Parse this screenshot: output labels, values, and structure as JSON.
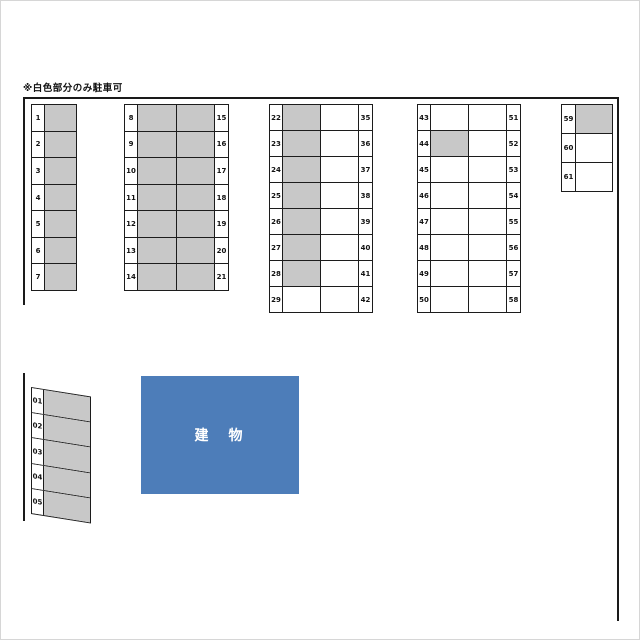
{
  "note": "※白色部分のみ駐車可",
  "building": {
    "label": "建　物"
  },
  "colors": {
    "occupied": "#c8c8c8",
    "available": "#ffffff",
    "building": "#4d7db9",
    "line": "#1a1a1a"
  },
  "blocks": [
    {
      "rows": [
        {
          "l": "1",
          "cells": [
            "g"
          ]
        },
        {
          "l": "2",
          "cells": [
            "g"
          ]
        },
        {
          "l": "3",
          "cells": [
            "g"
          ]
        },
        {
          "l": "4",
          "cells": [
            "g"
          ]
        },
        {
          "l": "5",
          "cells": [
            "g"
          ]
        },
        {
          "l": "6",
          "cells": [
            "g"
          ]
        },
        {
          "l": "7",
          "cells": [
            "g"
          ]
        }
      ]
    },
    {
      "rows": [
        {
          "l": "8",
          "cells": [
            "g",
            "g"
          ],
          "r": "15"
        },
        {
          "l": "9",
          "cells": [
            "g",
            "g"
          ],
          "r": "16"
        },
        {
          "l": "10",
          "cells": [
            "g",
            "g"
          ],
          "r": "17"
        },
        {
          "l": "11",
          "cells": [
            "g",
            "g"
          ],
          "r": "18"
        },
        {
          "l": "12",
          "cells": [
            "g",
            "g"
          ],
          "r": "19"
        },
        {
          "l": "13",
          "cells": [
            "g",
            "g"
          ],
          "r": "20"
        },
        {
          "l": "14",
          "cells": [
            "g",
            "g"
          ],
          "r": "21"
        }
      ]
    },
    {
      "rows": [
        {
          "l": "22",
          "cells": [
            "g",
            "w"
          ],
          "r": "35"
        },
        {
          "l": "23",
          "cells": [
            "g",
            "w"
          ],
          "r": "36"
        },
        {
          "l": "24",
          "cells": [
            "g",
            "w"
          ],
          "r": "37"
        },
        {
          "l": "25",
          "cells": [
            "g",
            "w"
          ],
          "r": "38"
        },
        {
          "l": "26",
          "cells": [
            "g",
            "w"
          ],
          "r": "39"
        },
        {
          "l": "27",
          "cells": [
            "g",
            "w"
          ],
          "r": "40"
        },
        {
          "l": "28",
          "cells": [
            "g",
            "w"
          ],
          "r": "41"
        },
        {
          "l": "29",
          "cells": [
            "w",
            "w"
          ],
          "r": "42"
        }
      ]
    },
    {
      "rows": [
        {
          "l": "43",
          "cells": [
            "w",
            "w"
          ],
          "r": "51"
        },
        {
          "l": "44",
          "cells": [
            "g",
            "w"
          ],
          "r": "52"
        },
        {
          "l": "45",
          "cells": [
            "w",
            "w"
          ],
          "r": "53"
        },
        {
          "l": "46",
          "cells": [
            "w",
            "w"
          ],
          "r": "54"
        },
        {
          "l": "47",
          "cells": [
            "w",
            "w"
          ],
          "r": "55"
        },
        {
          "l": "48",
          "cells": [
            "w",
            "w"
          ],
          "r": "56"
        },
        {
          "l": "49",
          "cells": [
            "w",
            "w"
          ],
          "r": "57"
        },
        {
          "l": "50",
          "cells": [
            "w",
            "w"
          ],
          "r": "58"
        }
      ]
    },
    {
      "rows": [
        {
          "l": "59",
          "cells": [
            "g"
          ]
        },
        {
          "l": "60",
          "cells": [
            "w"
          ]
        },
        {
          "l": "61",
          "cells": [
            "w"
          ]
        }
      ]
    },
    {
      "rows": [
        {
          "l": "01",
          "cells": [
            "g"
          ]
        },
        {
          "l": "02",
          "cells": [
            "g"
          ]
        },
        {
          "l": "03",
          "cells": [
            "g"
          ]
        },
        {
          "l": "04",
          "cells": [
            "g"
          ]
        },
        {
          "l": "05",
          "cells": [
            "g"
          ]
        }
      ]
    }
  ]
}
